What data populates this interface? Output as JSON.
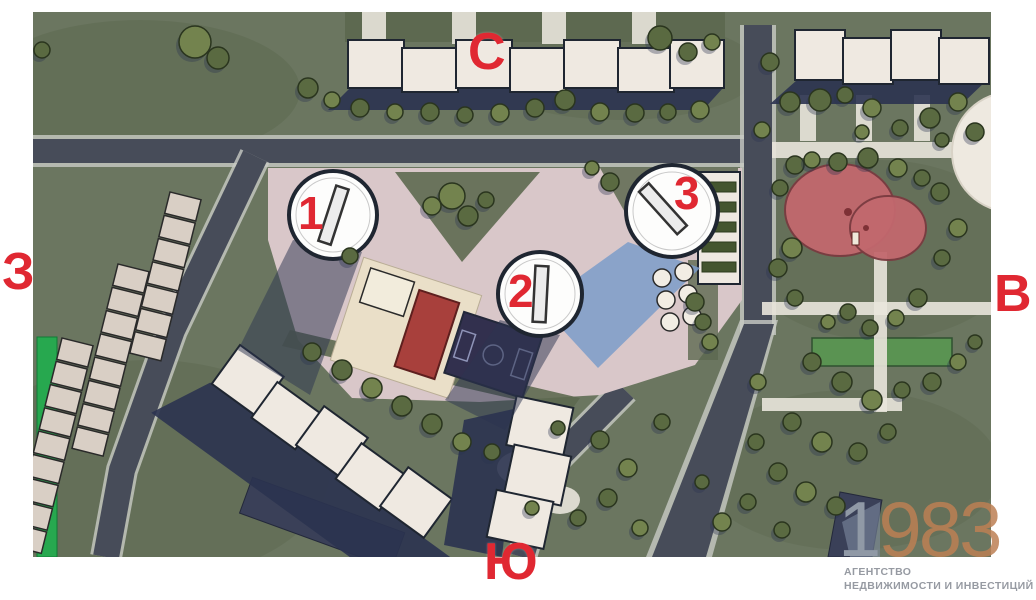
{
  "compass": {
    "north": "С",
    "south": "Ю",
    "west": "З",
    "east": "В"
  },
  "markers": {
    "tower1": "1",
    "tower2": "2",
    "tower3": "3"
  },
  "watermark": {
    "digit_lead": "1",
    "digits_rest": "983",
    "line1": "АГЕНТСТВО",
    "line2": "НЕДВИЖИМОСТИ И ИНВЕСТИЦИЙ"
  },
  "palette": {
    "grass": "#6b7660",
    "grass_dark": "#5d6950",
    "road": "#474c59",
    "road_edge": "#c8cbc4",
    "building": "#efe9e1",
    "outline": "#1f2631",
    "shadow": "#2b3350",
    "shadow_blue": "#7b9cc9",
    "pavement": "#d9c7c9",
    "courtyard": "#eadfc8",
    "path": "#e9e5dc",
    "playground_red": "#a8403c",
    "playground_pink": "#c2686e",
    "court_navy": "#32304e",
    "tree": "#5a6a41",
    "tree_light": "#73834e",
    "tree_dark": "#2a351e",
    "garage": "#d9cfc5",
    "green_strip": "#27a84f",
    "lawn_green": "#5a9352",
    "accent_red": "#e02832",
    "watermark_gray": "#9099a6",
    "watermark_copper": "#bd8054",
    "watermark_text": "#969aa2"
  }
}
